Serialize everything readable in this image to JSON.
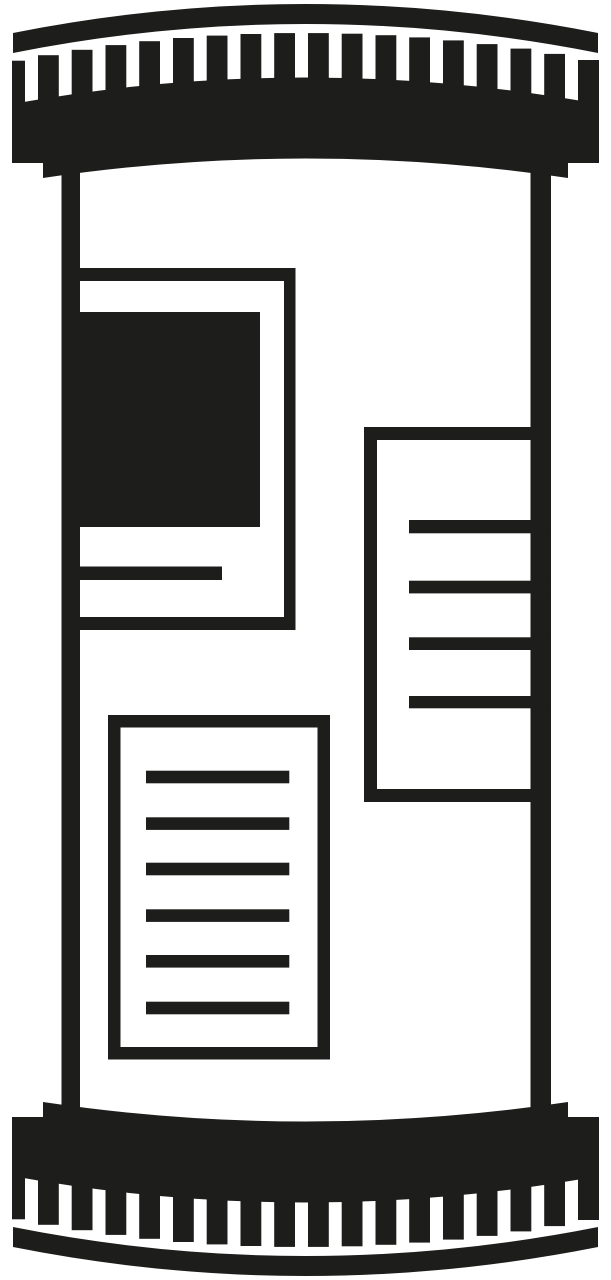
{
  "meta": {
    "type": "icon-illustration",
    "description": "Black and white pictogram of an advertising column (Litfass column): cylinder with striped domed cap and striped base, carrying three blank posters"
  },
  "icon": {
    "name": "advertising-column-icon",
    "foreground": "#1d1d1b",
    "background": "#ffffff",
    "parts": [
      "top-cap-arc",
      "top-cap-teeth",
      "column-left-edge",
      "column-right-edge",
      "poster-top-left-with-photo",
      "poster-right-with-lines",
      "poster-bottom-left-with-text-lines",
      "bottom-cap-teeth",
      "bottom-cap-arc"
    ]
  }
}
